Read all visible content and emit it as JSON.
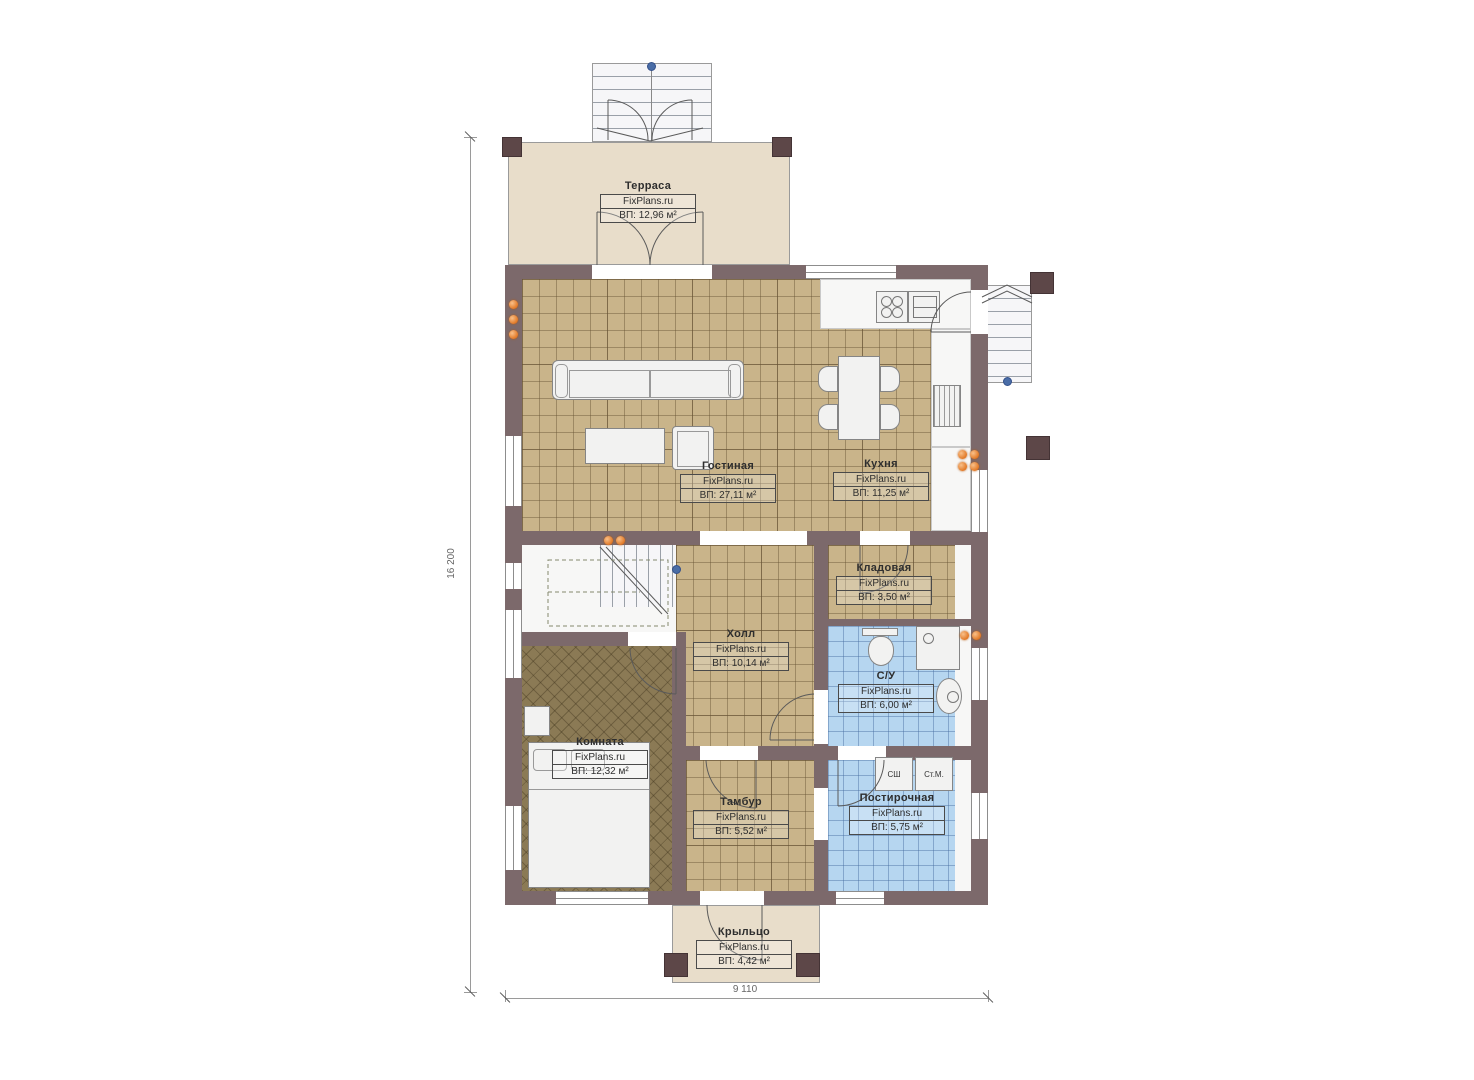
{
  "brand": "FixPlans.ru",
  "dimensions": {
    "height_label": "16 200",
    "width_label": "9 110"
  },
  "rooms": [
    {
      "name": "Терраса",
      "brand": "FixPlans.ru",
      "area": "ВП: 12,96 м²"
    },
    {
      "name": "Гостиная",
      "brand": "FixPlans.ru",
      "area": "ВП: 27,11 м²"
    },
    {
      "name": "Кухня",
      "brand": "FixPlans.ru",
      "area": "ВП: 11,25 м²"
    },
    {
      "name": "Кладовая",
      "brand": "FixPlans.ru",
      "area": "ВП: 3,50 м²"
    },
    {
      "name": "Холл",
      "brand": "FixPlans.ru",
      "area": "ВП: 10,14 м²"
    },
    {
      "name": "С/У",
      "brand": "FixPlans.ru",
      "area": "ВП: 6,00 м²"
    },
    {
      "name": "Комната",
      "brand": "FixPlans.ru",
      "area": "ВП: 12,32 м²"
    },
    {
      "name": "Тамбур",
      "brand": "FixPlans.ru",
      "area": "ВП: 5,52 м²"
    },
    {
      "name": "Постирочная",
      "brand": "FixPlans.ru",
      "area": "ВП: 5,75 м²"
    },
    {
      "name": "Крыльцо",
      "brand": "FixPlans.ru",
      "area": "ВП: 4,42 м²"
    }
  ],
  "appliances": {
    "dryer": "СШ",
    "washer": "Ст.М."
  },
  "colors": {
    "wall": "#7c696b",
    "pillar": "#5d4748",
    "tile_beige": "#c9b48a",
    "tile_blue": "#b6d6f0",
    "floor_dark": "#8b7a55",
    "deck": "#e8ddca",
    "radiator_orange": "#e0731e",
    "marker_blue": "#4a6da7"
  }
}
